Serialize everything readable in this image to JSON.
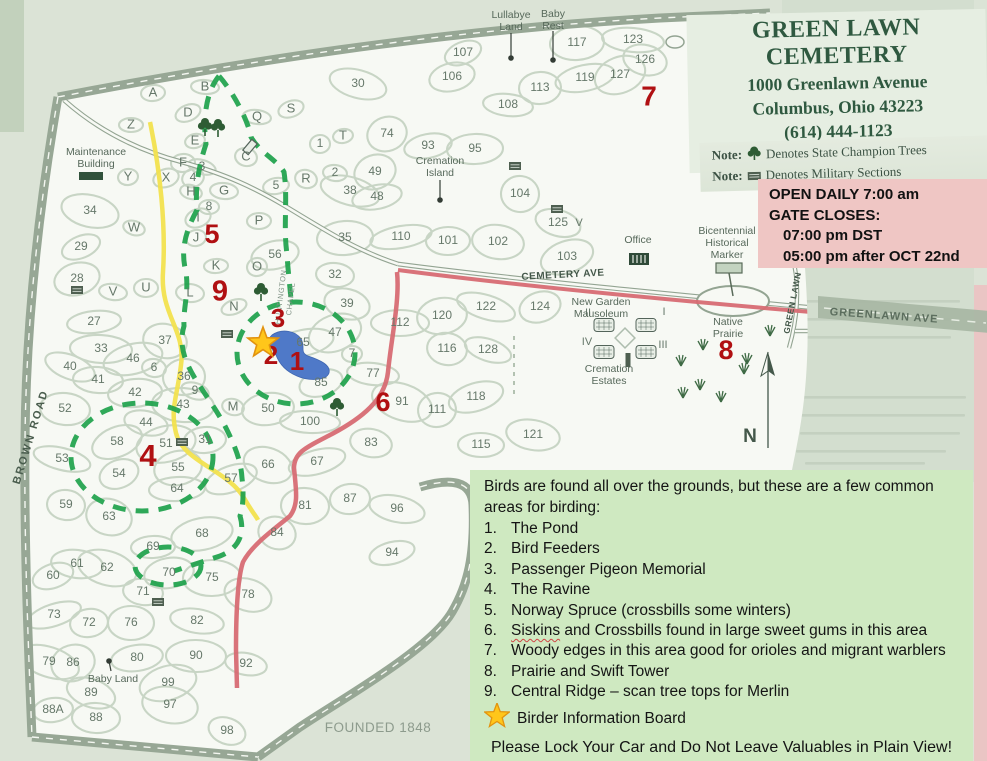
{
  "header": {
    "title": "GREEN LAWN CEMETERY",
    "address": "1000 Greenlawn Avenue",
    "city": "Columbus, Ohio 43223",
    "phone": "(614) 444-1123",
    "website": "www.greenlawncemetery.org"
  },
  "notes": [
    {
      "label": "Note:",
      "icon": "champion-tree-icon",
      "text": "Denotes State Champion Trees"
    },
    {
      "label": "Note:",
      "icon": "military-section-icon",
      "text": "Denotes Military Sections"
    }
  ],
  "hours_box": {
    "line1": "OPEN DAILY 7:00 am",
    "line2": "GATE CLOSES:",
    "line3": "07:00 pm DST",
    "line4": "05:00 pm after OCT 22nd"
  },
  "birding_box": {
    "intro": "Birds are found all over the grounds, but these are a few common areas for birding:",
    "items": [
      {
        "num": "1.",
        "text": "The Pond"
      },
      {
        "num": "2.",
        "text": "Bird Feeders"
      },
      {
        "num": "3.",
        "text": "Passenger Pigeon Memorial"
      },
      {
        "num": "4.",
        "text": "The Ravine"
      },
      {
        "num": "5.",
        "text": "Norway Spruce (crossbills some winters)"
      },
      {
        "num": "6.",
        "text": "Siskins and Crossbills found in large sweet gums in this area",
        "wavy": "Siskins"
      },
      {
        "num": "7.",
        "text": "Woody edges in this area good for orioles and migrant warblers"
      },
      {
        "num": "8.",
        "text": "Prairie and Swift Tower"
      },
      {
        "num": "9.",
        "text": "Central Ridge – scan tree tops for Merlin"
      }
    ],
    "star_label": "Birder Information Board",
    "warning": "Please Lock Your Car and Do Not Leave Valuables in Plain View!"
  },
  "map": {
    "founded": "FOUNDED 1848",
    "compass": "N",
    "road_labels": [
      {
        "t": "BROWN ROAD",
        "x": 31,
        "y": 437,
        "r": -73,
        "fs": 11,
        "ls": 2,
        "w": 600,
        "c": "#4a5d4e"
      },
      {
        "t": "CEMETERY AVE",
        "x": 563,
        "y": 275,
        "r": -3,
        "fs": 10,
        "ls": 0.5,
        "w": 600,
        "c": "#44584a"
      },
      {
        "t": "GREENLAWN AVE",
        "x": 884,
        "y": 316,
        "r": 4,
        "fs": 11,
        "ls": 1,
        "w": 700,
        "c": "#5c6e5e"
      },
      {
        "t": "GREEN LAWN",
        "x": 793,
        "y": 303,
        "r": -79,
        "fs": 8.5,
        "ls": 0.5,
        "w": 700,
        "c": "#44584a"
      },
      {
        "t": "HUNTINGTON",
        "x": 281,
        "y": 297,
        "r": -83,
        "fs": 7.5,
        "ls": 0.5,
        "w": 400,
        "c": "#7f9184"
      },
      {
        "t": "CHAPEL",
        "x": 291,
        "y": 299,
        "r": -83,
        "fs": 7.5,
        "ls": 0.5,
        "w": 400,
        "c": "#7f9184"
      }
    ],
    "place_labels": [
      {
        "lines": [
          "Maintenance",
          "Building"
        ],
        "x": 96,
        "y": 152
      },
      {
        "lines": [
          "Lullabye",
          "Land"
        ],
        "x": 511,
        "y": 15
      },
      {
        "lines": [
          "Baby",
          "Rest"
        ],
        "x": 553,
        "y": 14
      },
      {
        "lines": [
          "Cremation",
          "Island"
        ],
        "x": 440,
        "y": 161
      },
      {
        "lines": [
          "Office"
        ],
        "x": 638,
        "y": 240
      },
      {
        "lines": [
          "Bicentennial",
          "Historical",
          "Marker"
        ],
        "x": 727,
        "y": 231
      },
      {
        "lines": [
          "New Garden",
          "Mausoleum"
        ],
        "x": 601,
        "y": 302
      },
      {
        "lines": [
          "Cremation",
          "Estates"
        ],
        "x": 609,
        "y": 369
      },
      {
        "lines": [
          "Native",
          "Prairie"
        ],
        "x": 728,
        "y": 322
      },
      {
        "lines": [
          "Baby Land"
        ],
        "x": 113,
        "y": 679
      }
    ],
    "sections": [
      [
        "107",
        463,
        53
      ],
      [
        "106",
        452,
        77
      ],
      [
        "117",
        577,
        43
      ],
      [
        "123",
        633,
        40
      ],
      [
        "126",
        645,
        60
      ],
      [
        "127",
        620,
        75
      ],
      [
        "119",
        585,
        78
      ],
      [
        "113",
        540,
        88
      ],
      [
        "108",
        508,
        105
      ],
      [
        "30",
        358,
        84
      ],
      [
        "74",
        387,
        134
      ],
      [
        "93",
        428,
        146
      ],
      [
        "95",
        475,
        149
      ],
      [
        "104",
        520,
        194
      ],
      [
        "125",
        558,
        223
      ],
      [
        "103",
        567,
        257
      ],
      [
        "110",
        401,
        237
      ],
      [
        "101",
        448,
        241
      ],
      [
        "102",
        498,
        242
      ],
      [
        "122",
        486,
        307
      ],
      [
        "124",
        540,
        307
      ],
      [
        "120",
        442,
        316
      ],
      [
        "112",
        400,
        323
      ],
      [
        "116",
        447,
        349
      ],
      [
        "128",
        488,
        350
      ],
      [
        "118",
        476,
        397
      ],
      [
        "111",
        437,
        410
      ],
      [
        "115",
        481,
        445
      ],
      [
        "121",
        533,
        435
      ],
      [
        "91",
        402,
        402
      ],
      [
        "85",
        321,
        383
      ],
      [
        "50",
        268,
        409
      ],
      [
        "100",
        310,
        422
      ],
      [
        "83",
        371,
        443
      ],
      [
        "66",
        268,
        465
      ],
      [
        "67",
        317,
        462
      ],
      [
        "87",
        350,
        499
      ],
      [
        "81",
        305,
        506
      ],
      [
        "96",
        397,
        509
      ],
      [
        "84",
        277,
        533
      ],
      [
        "94",
        392,
        553
      ],
      [
        "42",
        135,
        393
      ],
      [
        "43",
        183,
        405
      ],
      [
        "44",
        146,
        423
      ],
      [
        "58",
        117,
        442
      ],
      [
        "51",
        166,
        444
      ],
      [
        "31",
        205,
        440
      ],
      [
        "52",
        65,
        409
      ],
      [
        "53",
        62,
        459
      ],
      [
        "54",
        119,
        474
      ],
      [
        "55",
        178,
        468
      ],
      [
        "64",
        177,
        489
      ],
      [
        "59",
        66,
        505
      ],
      [
        "63",
        109,
        517
      ],
      [
        "57",
        231,
        479
      ],
      [
        "68",
        202,
        534
      ],
      [
        "69",
        153,
        547
      ],
      [
        "61",
        77,
        564
      ],
      [
        "62",
        107,
        568
      ],
      [
        "60",
        53,
        576
      ],
      [
        "70",
        169,
        573
      ],
      [
        "75",
        212,
        578
      ],
      [
        "71",
        143,
        592
      ],
      [
        "78",
        248,
        595
      ],
      [
        "73",
        54,
        615
      ],
      [
        "72",
        89,
        623
      ],
      [
        "76",
        131,
        623
      ],
      [
        "82",
        197,
        621
      ],
      [
        "79",
        49,
        662
      ],
      [
        "86",
        73,
        663
      ],
      [
        "80",
        137,
        658
      ],
      [
        "90",
        196,
        656
      ],
      [
        "92",
        246,
        664
      ],
      [
        "89",
        91,
        693
      ],
      [
        "99",
        168,
        683
      ],
      [
        "88A",
        53,
        710
      ],
      [
        "88",
        96,
        718
      ],
      [
        "97",
        170,
        705
      ],
      [
        "98",
        227,
        731
      ],
      [
        "28",
        77,
        279
      ],
      [
        "27",
        94,
        322
      ],
      [
        "33",
        101,
        349
      ],
      [
        "37",
        165,
        341
      ],
      [
        "40",
        70,
        367
      ],
      [
        "46",
        133,
        359
      ],
      [
        "36",
        184,
        377
      ],
      [
        "41",
        98,
        380
      ],
      [
        "34",
        90,
        211
      ],
      [
        "29",
        81,
        247
      ],
      [
        "56",
        275,
        255
      ],
      [
        "35",
        345,
        238
      ],
      [
        "32",
        335,
        275
      ],
      [
        "39",
        347,
        304
      ],
      [
        "47",
        335,
        333
      ],
      [
        "65",
        303,
        343
      ],
      [
        "7",
        352,
        354
      ],
      [
        "77",
        373,
        374
      ],
      [
        "38",
        350,
        191
      ],
      [
        "49",
        375,
        172
      ],
      [
        "48",
        377,
        197
      ],
      [
        "1",
        320,
        144
      ],
      [
        "2",
        335,
        173
      ],
      [
        "3",
        202,
        167
      ],
      [
        "4",
        193,
        178
      ],
      [
        "5",
        276,
        186
      ],
      [
        "8",
        209,
        207
      ],
      [
        "6",
        154,
        368
      ],
      [
        "9",
        195,
        391
      ]
    ],
    "letters": [
      [
        "A",
        153,
        93
      ],
      [
        "B",
        205,
        87
      ],
      [
        "C",
        246,
        157
      ],
      [
        "D",
        188,
        113
      ],
      [
        "E",
        195,
        141
      ],
      [
        "F",
        183,
        163
      ],
      [
        "G",
        224,
        191
      ],
      [
        "H",
        191,
        192
      ],
      [
        "I",
        198,
        218
      ],
      [
        "J",
        196,
        238
      ],
      [
        "K",
        216,
        266
      ],
      [
        "L",
        190,
        293
      ],
      [
        "M",
        233,
        407
      ],
      [
        "N",
        234,
        307
      ],
      [
        "O",
        257,
        267
      ],
      [
        "P",
        259,
        221
      ],
      [
        "Q",
        257,
        117
      ],
      [
        "R",
        306,
        179
      ],
      [
        "S",
        291,
        109
      ],
      [
        "T",
        343,
        136
      ],
      [
        "U",
        146,
        288
      ],
      [
        "V",
        113,
        292
      ],
      [
        "W",
        134,
        228
      ],
      [
        "X",
        166,
        178
      ],
      [
        "Y",
        128,
        177
      ],
      [
        "Z",
        131,
        125
      ]
    ],
    "romans": [
      [
        "II",
        588,
        313
      ],
      [
        "I",
        664,
        312
      ],
      [
        "IV",
        587,
        342
      ],
      [
        "III",
        663,
        345
      ],
      [
        "V",
        579,
        223
      ]
    ],
    "birding_markers": [
      [
        "1",
        297,
        363,
        26
      ],
      [
        "2",
        271,
        357,
        26
      ],
      [
        "3",
        278,
        320,
        26
      ],
      [
        "4",
        148,
        458,
        31
      ],
      [
        "5",
        212,
        236,
        27
      ],
      [
        "6",
        383,
        404,
        27
      ],
      [
        "7",
        649,
        98,
        28
      ],
      [
        "8",
        726,
        352,
        27
      ],
      [
        "9",
        220,
        293,
        29
      ]
    ],
    "star": {
      "x": 263,
      "y": 343
    },
    "trees": [
      [
        205,
        125
      ],
      [
        218,
        126
      ],
      [
        261,
        290
      ],
      [
        337,
        405
      ]
    ],
    "military": [
      [
        77,
        290
      ],
      [
        182,
        442
      ],
      [
        158,
        602
      ],
      [
        515,
        166
      ],
      [
        557,
        209
      ],
      [
        227,
        334
      ]
    ],
    "grass": [
      [
        681,
        366
      ],
      [
        703,
        350
      ],
      [
        744,
        374
      ],
      [
        700,
        390
      ],
      [
        770,
        336
      ],
      [
        747,
        364
      ],
      [
        721,
        402
      ],
      [
        683,
        398
      ]
    ],
    "buildings": {
      "maintenance": [
        91,
        176
      ],
      "office": [
        639,
        259
      ],
      "marker": [
        729,
        268
      ],
      "mausoleum": [
        625,
        338
      ],
      "chapel": [
        250,
        147
      ],
      "pillar": [
        628,
        360
      ]
    },
    "dots": [
      [
        511,
        58,
        511,
        33
      ],
      [
        553,
        60,
        553,
        31
      ],
      [
        440,
        200,
        440,
        180
      ],
      [
        109,
        661,
        111,
        671
      ]
    ]
  },
  "colors": {
    "paper": "#f7f9f4",
    "band": "#97a795",
    "ink": "#66786a",
    "blob": "#c8d5c5",
    "red_marker": "#b01012",
    "trail": "#1ea24b",
    "road_red": "#d76b73",
    "road_yellow": "#f2e14e",
    "pond": "#4f79c8",
    "star": "#ffc61a",
    "pink_box": "#efc6c4",
    "green_box": "#cfe9c1",
    "header_green": "#2f5940"
  }
}
